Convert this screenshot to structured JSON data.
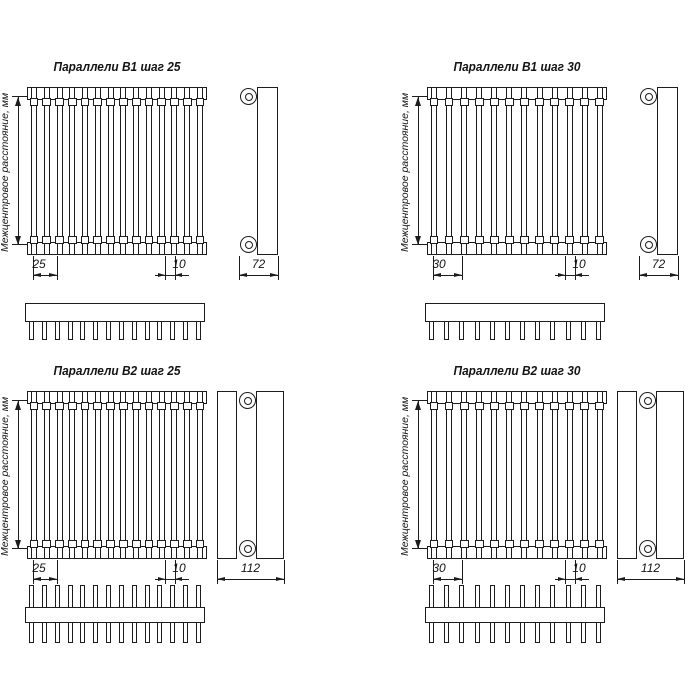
{
  "drawing": {
    "background": "#ffffff",
    "line_color": "#1c1c1c",
    "vertical_label": "Межцентровое расстояние, мм",
    "quadrants": [
      {
        "id": "b1-step-25",
        "title": "Параллели В1 шаг 25",
        "series": "В1",
        "step_mm": 25,
        "tube_count": 14,
        "comb_teeth": 14,
        "comb_double_sided": false,
        "dim_pitch": "25",
        "dim_edge": "10",
        "dim_depth": "72"
      },
      {
        "id": "b1-step-30",
        "title": "Параллели В1 шаг 30",
        "series": "В1",
        "step_mm": 30,
        "tube_count": 12,
        "comb_teeth": 12,
        "comb_double_sided": false,
        "dim_pitch": "30",
        "dim_edge": "10",
        "dim_depth": "72"
      },
      {
        "id": "b2-step-25",
        "title": "Параллели В2 шаг 25",
        "series": "В2",
        "step_mm": 25,
        "tube_count": 14,
        "comb_teeth": 14,
        "comb_double_sided": true,
        "dim_pitch": "25",
        "dim_edge": "10",
        "dim_depth": "112"
      },
      {
        "id": "b2-step-30",
        "title": "Параллели В2 шаг 30",
        "series": "В2",
        "step_mm": 30,
        "tube_count": 12,
        "comb_teeth": 12,
        "comb_double_sided": true,
        "dim_pitch": "30",
        "dim_edge": "10",
        "dim_depth": "112"
      }
    ]
  }
}
